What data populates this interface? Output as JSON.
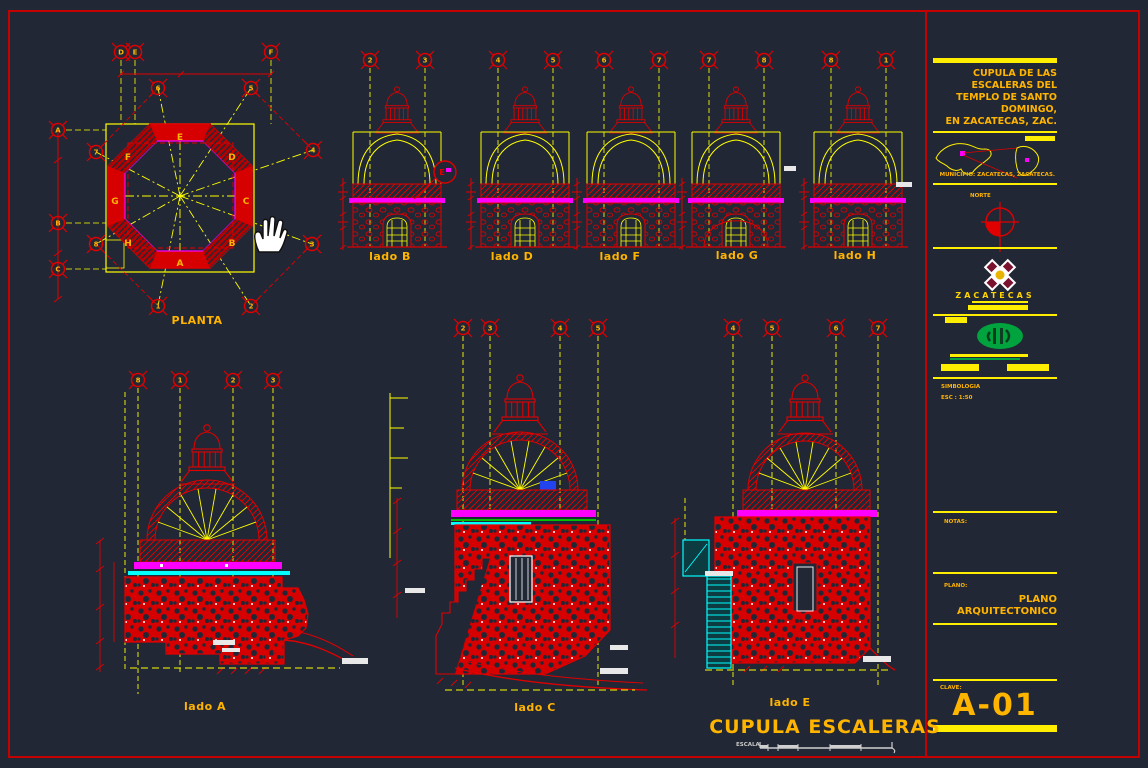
{
  "colors": {
    "background": "#212735",
    "line_red": "#e00000",
    "line_yellow": "#ffff00",
    "text_orange": "#ffb400",
    "magenta": "#ff00ff",
    "cyan": "#00ffff",
    "green": "#00a33d",
    "white": "#ffffff"
  },
  "plan": {
    "title": "PLANTA",
    "v_bubbles": [
      "D",
      "E",
      "F"
    ],
    "h_bubbles": [
      "A",
      "B",
      "C"
    ],
    "r_bubbles": [
      "1",
      "2",
      "3",
      "4",
      "5",
      "6",
      "7",
      "8"
    ],
    "side_letters": [
      "A",
      "B",
      "C",
      "D",
      "E",
      "F",
      "G",
      "H"
    ]
  },
  "elevations": [
    {
      "label": "lado B",
      "bubbles": [
        "2",
        "3"
      ],
      "callout": "E"
    },
    {
      "label": "lado D",
      "bubbles": [
        "4",
        "5"
      ]
    },
    {
      "label": "lado F",
      "bubbles": [
        "6",
        "7"
      ]
    },
    {
      "label": "lado G",
      "bubbles": [
        "7",
        "8"
      ]
    },
    {
      "label": "lado H",
      "bubbles": [
        "8",
        "1"
      ]
    }
  ],
  "sections": [
    {
      "label": "lado A",
      "bubbles": [
        "8",
        "1",
        "2",
        "3"
      ]
    },
    {
      "label": "lado C",
      "bubbles": [
        "2",
        "3",
        "4",
        "5"
      ]
    },
    {
      "label": "lado E",
      "bubbles": [
        "4",
        "5",
        "6",
        "7"
      ]
    }
  ],
  "titleblock": {
    "project_title_lines": [
      "CUPULA DE LAS",
      "ESCALERAS DEL",
      "TEMPLO DE SANTO",
      "DOMINGO,",
      "EN ZACATECAS, ZAC."
    ],
    "municipio": "MUNICIPIO: ZACATECAS, ZACATECAS.",
    "norte": "NORTE",
    "estado": "ZACATECAS",
    "simbologia": "SIMBOLOGIA",
    "escala": "ESC : 1:50",
    "notas": "NOTAS:",
    "plano_label": "PLANO:",
    "plano_line1": "PLANO",
    "plano_line2": "ARQUITECTONICO",
    "clave_label": "CLAVE:",
    "clave": "A-01"
  },
  "footer": {
    "title": "CUPULA ESCALERAS",
    "escala_label": "ESCALA"
  }
}
